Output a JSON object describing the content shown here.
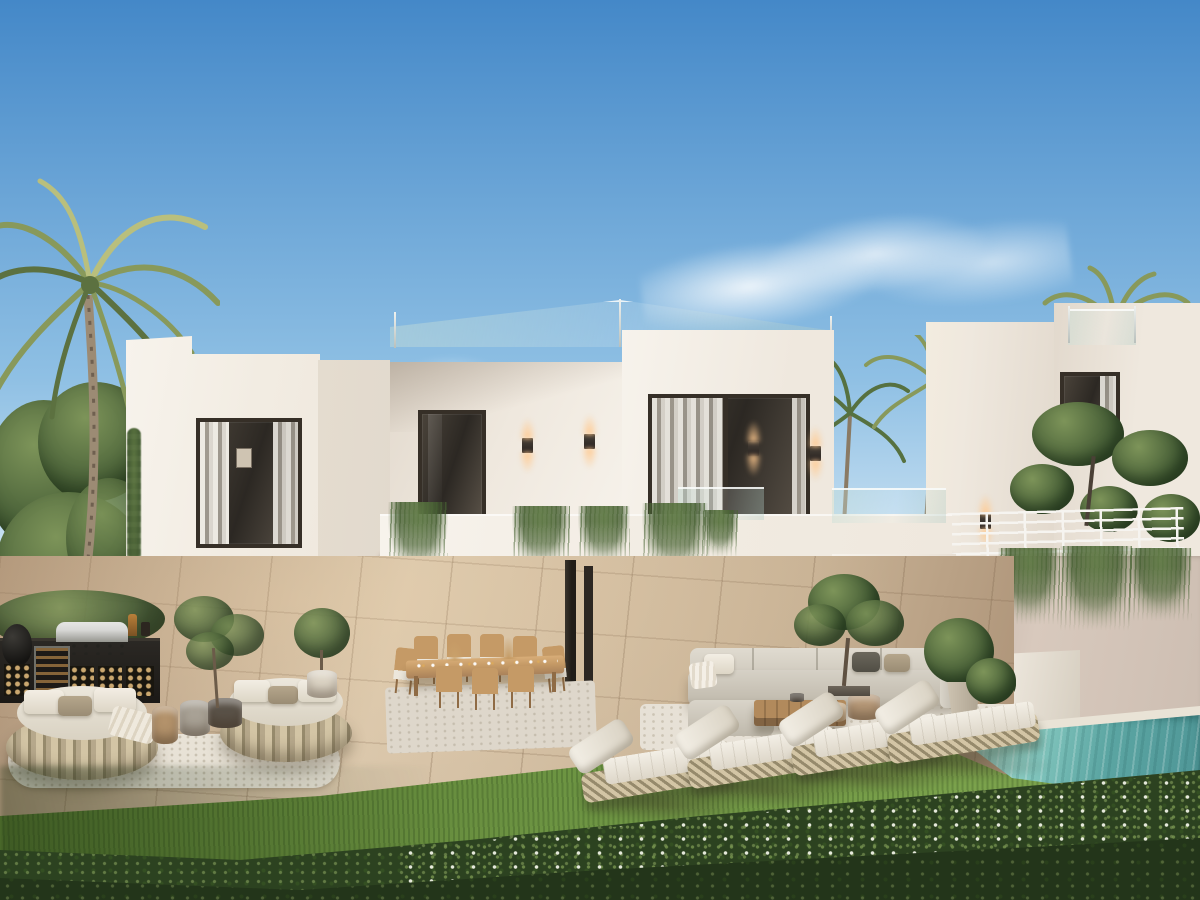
{
  "palette": {
    "sky_top": "#4488c8",
    "sky_mid": "#8fc0e4",
    "sky_low": "#d9eaf6",
    "cloud": "#ffffff",
    "wall_bright": "#f7f3ec",
    "wall_light": "#efe8de",
    "wall_shade": "#e2d9cd",
    "wall_deep": "#cfc5b9",
    "wall_side": "#e4dccf",
    "soffit": "#d9d1c5",
    "frame_dark": "#362f27",
    "glass_dark": "#2c2823",
    "curtain": "#eee9e1",
    "rail_white": "#f6f4f0",
    "glow": "#ffc98f",
    "green_dark": "#3c5430",
    "green_mid": "#567140",
    "green_light": "#7d9459",
    "palm_dark": "#5c7140",
    "palm_mid": "#88995b",
    "palm_light": "#b9bf7d",
    "trunk": "#9c8b74",
    "grass_dark": "#55762f",
    "grass_mid": "#6c9342",
    "grass_light": "#7ba24c",
    "hedge_dark": "#2c4220",
    "hedge_leaf": "#8fa963",
    "flower": "#eef0e2",
    "patio_light": "#d9c6ab",
    "patio_mid": "#c8b295",
    "patio_dark": "#ab9176",
    "pool_light": "#8fd0c6",
    "pool_mid": "#5ba5a2",
    "pool_deep": "#4e9596",
    "coping": "#e9e3d6",
    "wicker_light": "#d3c5a5",
    "wicker_dark": "#968a6c",
    "cushion": "#ece7dc",
    "wood": "#c59a66",
    "wood_dark": "#8f6b45",
    "sofa_back": "#e0dbd0",
    "sofa_seat": "#d6d1c6",
    "steel_light": "#d8d8d6",
    "steel_dark": "#96968f",
    "black": "#23211e",
    "wall_pink": "#d8c9bd",
    "wall_pink_deep": "#c3b3a8"
  },
  "scene": {
    "setting": "Photorealistic dusk rendering of a modern two-storey white villa with rooftop glass railing, landscaped garden terrace and turquoise plunge pool",
    "sky": {
      "condition": "clear blue with one thin wispy cloud"
    },
    "buildings": {
      "main_villa": {
        "storeys": 2,
        "features": [
          "rooftop glass balustrade",
          "balcony parapet with trailing plants",
          "floor-to-ceiling glazing",
          "open-plan living room",
          "covered dining terrace"
        ]
      },
      "neighbor_villa": {
        "storeys": 2,
        "features": [
          "rooftop glass balustrade",
          "white horizontal-bar terrace railing",
          "retaining wall with trailing plants"
        ]
      }
    },
    "vegetation": [
      "tall coconut palm",
      "eucalyptus tree cluster",
      "tropical palm grove",
      "sculpted topiary pines",
      "trailing wall plants",
      "olive trees",
      "flowering hedge",
      "lawn"
    ],
    "furniture_counts": {
      "round_daybeds": 2,
      "sun_loungers": 4,
      "dining_chairs": 9,
      "dining_tables": 1,
      "outdoor_sofas": 1,
      "coffee_tables": 1,
      "side_tables": 3,
      "planter_pots": 6
    },
    "outdoor_kitchen": [
      "stainless bbq grill",
      "wine fridge",
      "kamado grill",
      "firewood cubbies"
    ],
    "lighting": {
      "wall_sconces": 8,
      "state": "lit warm"
    },
    "pool": {
      "shape": "rectangular",
      "water_color": "turquoise"
    }
  }
}
